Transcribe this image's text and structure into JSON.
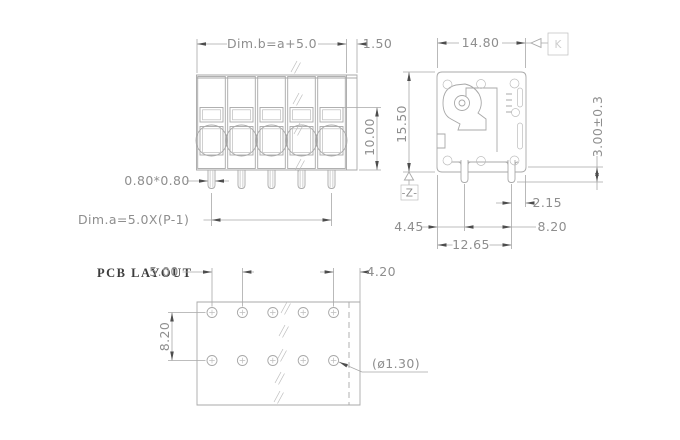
{
  "drawing": {
    "front_view": {
      "positions": 5,
      "dim_width": "Dim.b=a+5.0",
      "dim_right_margin": "1.50",
      "dim_height": "10.00",
      "dim_pin_size": "0.80*0.80",
      "dim_pitch": "Dim.a=5.0X(P-1)"
    },
    "side_view": {
      "dim_width": "14.80",
      "dim_height": "15.50",
      "dim_pin_protrusion": "3.00±0.3",
      "dim_pin_to_edge": "2.15",
      "dim_edge_to_pin": "4.45",
      "dim_pin_pitch": "8.20",
      "dim_overall": "12.65",
      "datum_label": "-Z-",
      "flag_label": "K"
    },
    "pcb_layout": {
      "title": "PCB LAYOUT",
      "holes_per_row": 5,
      "rows": 2,
      "dim_hole_pitch": "5.00",
      "dim_right_margin": "4.20",
      "dim_row_pitch": "8.20",
      "hole_diameter": "(ø1.30)"
    },
    "colors": {
      "line": "#a8a8a8",
      "line_light": "#bdbdbd",
      "text": "#8e8e8e",
      "arrow": "#4d4d4d",
      "title_text": "#3d3d3d"
    }
  }
}
